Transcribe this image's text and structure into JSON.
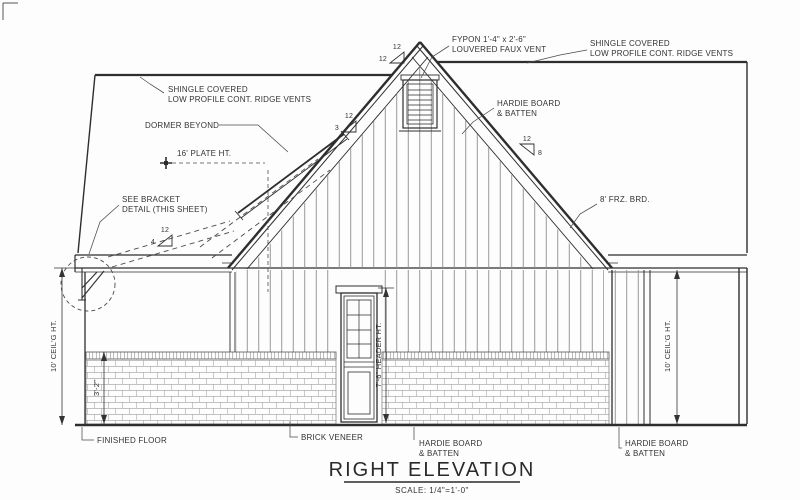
{
  "drawing_type": "architectural elevation",
  "title_block": {
    "title": "RIGHT ELEVATION",
    "scale": "SCALE: 1/4\"=1'-0\""
  },
  "labels": {
    "ridge_vents": {
      "line1": "SHINGLE COVERED",
      "line2": "LOW PROFILE CONT. RIDGE VENTS"
    },
    "faux_vent": {
      "line1": "FYPON 1'-4\" x 2'-6\"",
      "line2": "LOUVERED FAUX VENT"
    },
    "dormer_beyond": "DORMER BEYOND",
    "plate_height": "16' PLATE HT.",
    "bracket_detail": {
      "line1": "SEE BRACKET",
      "line2": "DETAIL (THIS SHEET)"
    },
    "frieze_board": "8' FRZ. BRD.",
    "hardie_board": {
      "line1": "HARDIE BOARD",
      "line2": "& BATTEN"
    },
    "brick_veneer": "BRICK VENEER",
    "finished_floor": "FINISHED FLOOR"
  },
  "dimensions": {
    "left_ceiling": "10' CEIL'G HT.",
    "right_ceiling": "10' CEIL'G HT.",
    "brick_height": "3'-2\"",
    "door_header": "7'-6\" HEADER HT."
  },
  "pitch_markers": {
    "gable": {
      "run": "12",
      "rise": "12"
    },
    "right_roof": {
      "run": "12",
      "rise": "8"
    },
    "dormer": {
      "run": "12",
      "rise": "3"
    },
    "porch": {
      "run": "12",
      "rise": "4"
    }
  },
  "colors": {
    "ink": "#2e2e2e",
    "hatch": "#8c8c8c",
    "brick": "#9a9a9a"
  }
}
